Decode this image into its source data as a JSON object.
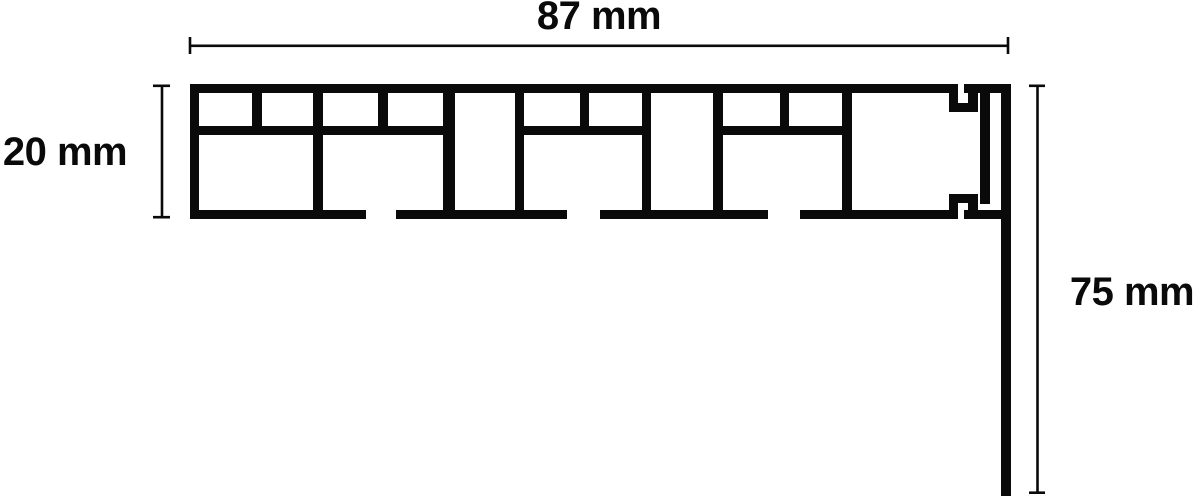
{
  "diagram": {
    "type": "technical-cross-section",
    "subject": "Profile cross-section drawing with dimension callouts",
    "background_color": "#ffffff",
    "line_color": "#0a0a0a",
    "dimensions": {
      "width": {
        "label": "87 mm",
        "value": 87,
        "unit": "mm",
        "position": "top"
      },
      "height": {
        "label": "20 mm",
        "value": 20,
        "unit": "mm",
        "position": "left"
      },
      "drop": {
        "label": "75 mm",
        "value": 75,
        "unit": "mm",
        "position": "right"
      }
    }
  }
}
